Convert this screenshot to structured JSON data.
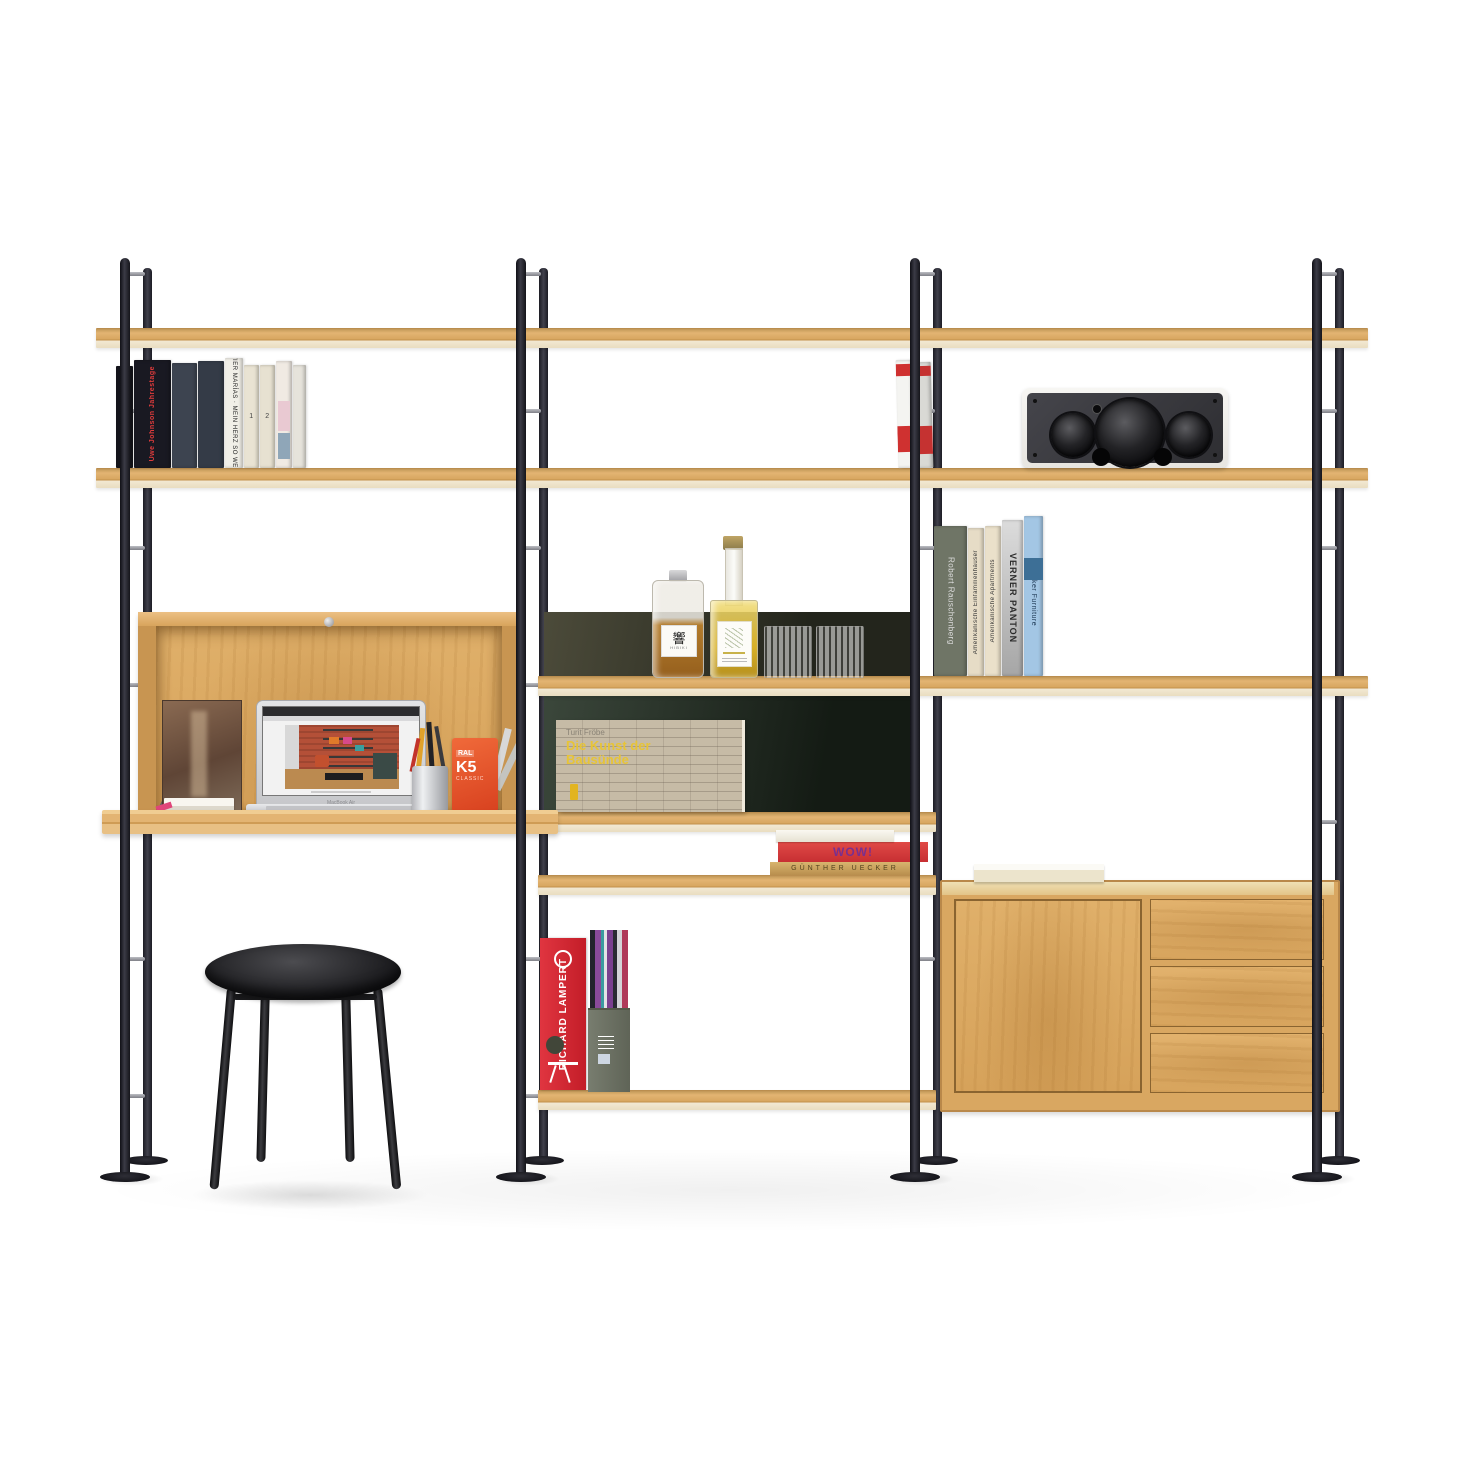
{
  "palette": {
    "background": "#ffffff",
    "wood_oak": "#dfae68",
    "wood_edge_light": "#f2e8d2",
    "frame_black": "#1b1b22",
    "rung_silver": "#8f9096",
    "panel_olive": "#43422f",
    "panel_green": "#2c3a2c",
    "accent_red": "#d7232f",
    "speaker_grille": "#38383c"
  },
  "left_bay": {
    "books": [
      {
        "title": ""
      },
      {
        "title": "Uwe Johnson Jahrestage"
      },
      {
        "title": ""
      },
      {
        "title": ""
      },
      {
        "title": "JAVIER MARÍAS · MEIN HERZ SO WEISS"
      },
      {
        "title": "1"
      },
      {
        "title": "2"
      },
      {
        "title": ""
      },
      {
        "title": ""
      }
    ],
    "desk": {
      "laptop_caption": "MacBook Air",
      "ral_fan": {
        "line1": "RAL",
        "line2": "K5",
        "line3": "CLASSIC"
      }
    }
  },
  "middle_bay": {
    "whisky_bottle": {
      "glyph": "響",
      "label": "HIBIKI"
    },
    "art_book": {
      "author": "Turit Fröbe",
      "title_line1": "Die Kunst der",
      "title_line2": "Bausünde"
    },
    "book_stack": {
      "middle": "WOW!",
      "bottom": "GÜNTHER UECKER"
    },
    "binder": {
      "label": "RICHARD LAMPERT"
    },
    "leaning_books": [
      {
        "title": ""
      },
      {
        "title": ""
      }
    ]
  },
  "right_bay": {
    "books": [
      {
        "title": "Robert Rauschenberg"
      },
      {
        "title": "Amerikanische Einfamilienhäuser"
      },
      {
        "title": "Amerikanische Apartments"
      },
      {
        "title": "VERNER PANTON"
      },
      {
        "title": "Shaker Furniture"
      }
    ]
  }
}
